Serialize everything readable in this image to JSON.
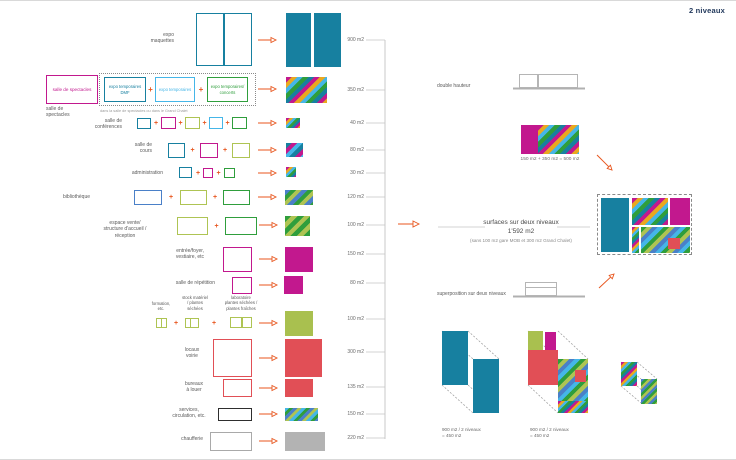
{
  "palette": {
    "teal": "#1780a0",
    "magenta": "#c2188e",
    "cyan": "#45b6e8",
    "green": "#2f9e3c",
    "olive": "#aec453",
    "olive_solid": "#a9c04f",
    "blue": "#4a80c8",
    "red": "#e14f56",
    "orange": "#e8561e",
    "yellow": "#e9a81f",
    "gray": "#b3b3b3",
    "gray_stroke": "#a9a9a9",
    "black": "#2e2e2e",
    "navy": "#22395c",
    "faint_line": "#c5c5c5"
  },
  "patterns": {
    "multi": {
      "colors": [
        "magenta",
        "yellow",
        "cyan",
        "green",
        "teal"
      ],
      "band": 4
    },
    "multi_sm": {
      "colors": [
        "magenta",
        "yellow",
        "cyan",
        "green",
        "teal"
      ],
      "band": 2.5
    },
    "teal_mc": {
      "colors": [
        "teal",
        "magenta",
        "cyan"
      ],
      "band": 4
    },
    "bib": {
      "colors": [
        "blue",
        "green",
        "olive"
      ],
      "band": 4
    },
    "bib_sm": {
      "colors": [
        "blue",
        "green",
        "olive"
      ],
      "band": 2.5
    },
    "vente": {
      "colors": [
        "green",
        "olive"
      ],
      "band": 4.5
    },
    "services": {
      "colors": [
        "cyan",
        "green",
        "blue",
        "olive"
      ],
      "band": 3
    },
    "greenmix": {
      "colors": [
        "green",
        "olive",
        "blue",
        "cyan"
      ],
      "band": 4
    }
  },
  "rows": [
    {
      "id": "expo-maquettes",
      "label_lines": [
        "expo",
        "maquettes"
      ],
      "area": "900 m2",
      "boxes": [
        {
          "color": "teal"
        }
      ],
      "result": {
        "kind": "solid",
        "color": "teal"
      }
    },
    {
      "id": "salle-de-spectacles",
      "label_lines": [
        "salle de",
        "spectacles"
      ],
      "area": "350 m2",
      "boxes": [
        {
          "color": "magenta",
          "text": "salle de spectacles"
        },
        {
          "color": "teal",
          "text": "expo temporaires DMF"
        },
        {
          "color": "cyan",
          "text": "expo temporaires"
        },
        {
          "color": "green",
          "text": "expo temporaires/ concerts"
        }
      ],
      "caption": "dans la salle de spectacles ou dans le Grand Chalet",
      "result": {
        "kind": "stripes",
        "pattern": "multi"
      }
    },
    {
      "id": "salle-de-conferences",
      "label_lines": [
        "salle de",
        "conférences"
      ],
      "area": "40 m2",
      "boxes": [
        {
          "color": "teal"
        },
        {
          "color": "magenta"
        },
        {
          "color": "olive"
        },
        {
          "color": "cyan"
        },
        {
          "color": "green"
        }
      ],
      "result": {
        "kind": "stripes",
        "pattern": "multi_sm"
      }
    },
    {
      "id": "salle-de-cours",
      "label_lines": [
        "salle de",
        "cours"
      ],
      "area": "80 m2",
      "boxes": [
        {
          "color": "teal"
        },
        {
          "color": "magenta"
        },
        {
          "color": "olive"
        }
      ],
      "result": {
        "kind": "stripes",
        "pattern": "teal_mc"
      }
    },
    {
      "id": "administration",
      "label_lines": [
        "administration"
      ],
      "area": "30 m2",
      "boxes": [
        {
          "color": "teal"
        },
        {
          "color": "magenta"
        },
        {
          "color": "green"
        }
      ],
      "result": {
        "kind": "stripes",
        "pattern": "multi_sm"
      }
    },
    {
      "id": "bibliotheque",
      "label_lines": [
        "bibliothèque"
      ],
      "area": "120 m2",
      "boxes": [
        {
          "color": "blue"
        },
        {
          "color": "olive"
        },
        {
          "color": "green"
        }
      ],
      "result": {
        "kind": "stripes",
        "pattern": "bib"
      }
    },
    {
      "id": "espace-vente",
      "label_lines": [
        "espace vente/",
        "structure d'accueil /",
        "réception"
      ],
      "area": "100 m2",
      "boxes": [
        {
          "color": "olive"
        },
        {
          "color": "green"
        }
      ],
      "result": {
        "kind": "stripes",
        "pattern": "vente"
      }
    },
    {
      "id": "entree-foyer",
      "label_lines": [
        "entrée/foyer,",
        "vestiaire, etc"
      ],
      "area": "150 m2",
      "boxes": [
        {
          "color": "magenta"
        }
      ],
      "result": {
        "kind": "solid",
        "color": "magenta"
      }
    },
    {
      "id": "salle-de-repetition",
      "label_lines": [
        "salle de répétition"
      ],
      "area": "80 m2",
      "boxes": [
        {
          "color": "magenta"
        }
      ],
      "result": {
        "kind": "solid",
        "color": "magenta"
      }
    },
    {
      "id": "ateliers-plantes",
      "group_labels": [
        [
          "formation,",
          "etc."
        ],
        [
          "stock matériel",
          "/ plantes",
          "séchées"
        ],
        [
          "laboratoire",
          "plantes séchées /",
          "plantes fraîches"
        ]
      ],
      "area": "100 m2",
      "boxes": [
        {
          "color": "olive"
        },
        {
          "color": "olive"
        },
        {
          "color": "olive"
        }
      ],
      "result": {
        "kind": "solid",
        "color": "olive_solid"
      }
    },
    {
      "id": "locaux-voirie",
      "label_lines": [
        "locaux",
        "voirie"
      ],
      "area": "300 m2",
      "boxes": [
        {
          "color": "red"
        }
      ],
      "result": {
        "kind": "solid",
        "color": "red"
      }
    },
    {
      "id": "bureaux-a-louer",
      "label_lines": [
        "bureaux",
        "à louer"
      ],
      "area": "135 m2",
      "boxes": [
        {
          "color": "red"
        }
      ],
      "result": {
        "kind": "solid",
        "color": "red"
      }
    },
    {
      "id": "services-circulation",
      "label_lines": [
        "services,",
        "circulation, etc."
      ],
      "area": "150 m2",
      "boxes": [
        {
          "color": "black"
        }
      ],
      "result": {
        "kind": "stripes",
        "pattern": "services"
      }
    },
    {
      "id": "chaufferie",
      "label_lines": [
        "chaufferie"
      ],
      "area": "220 m2",
      "boxes": [
        {
          "color": "gray_stroke"
        }
      ],
      "result": {
        "kind": "solid",
        "color": "gray"
      }
    }
  ],
  "summary": {
    "title": "surfaces sur deux niveaux",
    "total": "1'592 m2",
    "note": "(sans 100 m2 gare MOB et 300 m2 Grand Chalet)"
  },
  "right_panel": {
    "corner_label": "2 niveaux",
    "double_hauteur_label": "double hauteur",
    "addition_label": "150 m2 + 350 m2 = 500 m2",
    "superposition_label": "superposition sur deux niveaux",
    "iso_labels": [
      {
        "line1": "900 m2 / 2 niveaux",
        "line2": "= 450 m2"
      },
      {
        "line1": "900 m2 / 2 niveaux",
        "line2": "= 450 m2"
      }
    ]
  }
}
